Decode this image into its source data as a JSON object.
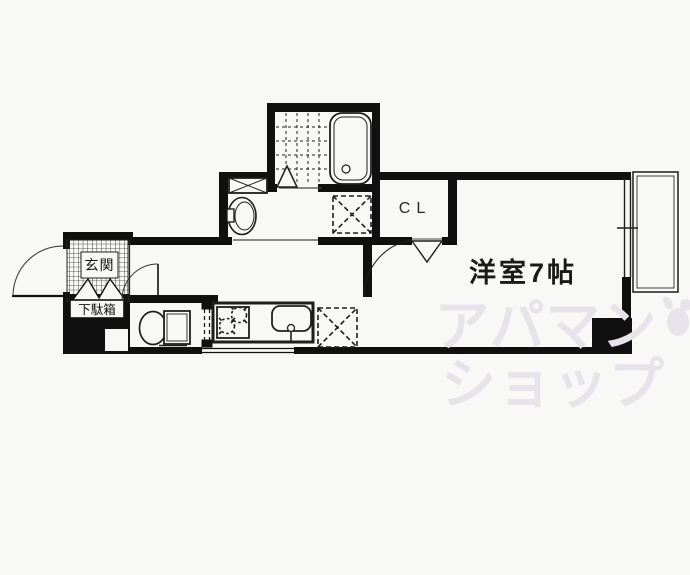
{
  "meta": {
    "type": "apartment-floorplan",
    "wall_color": "#101010",
    "fixture_line_color": "#1e1e1e",
    "watermark_color": "#e6e4ea",
    "background": "#f8f8f6"
  },
  "labels": {
    "main_room": "洋室7帖",
    "closet": "CL",
    "entrance": "玄関",
    "shoe_cabinet": "下駄箱"
  },
  "fixtures": [
    "bathtub",
    "shower-room",
    "washing-machine-space",
    "washbasin",
    "toilet",
    "kitchen-counter",
    "gas-stove",
    "kitchen-sink",
    "refrigerator-space",
    "balcony",
    "entrance-door",
    "room-door"
  ],
  "watermark": {
    "line1": "アパマン",
    "line2": "ショップ"
  }
}
